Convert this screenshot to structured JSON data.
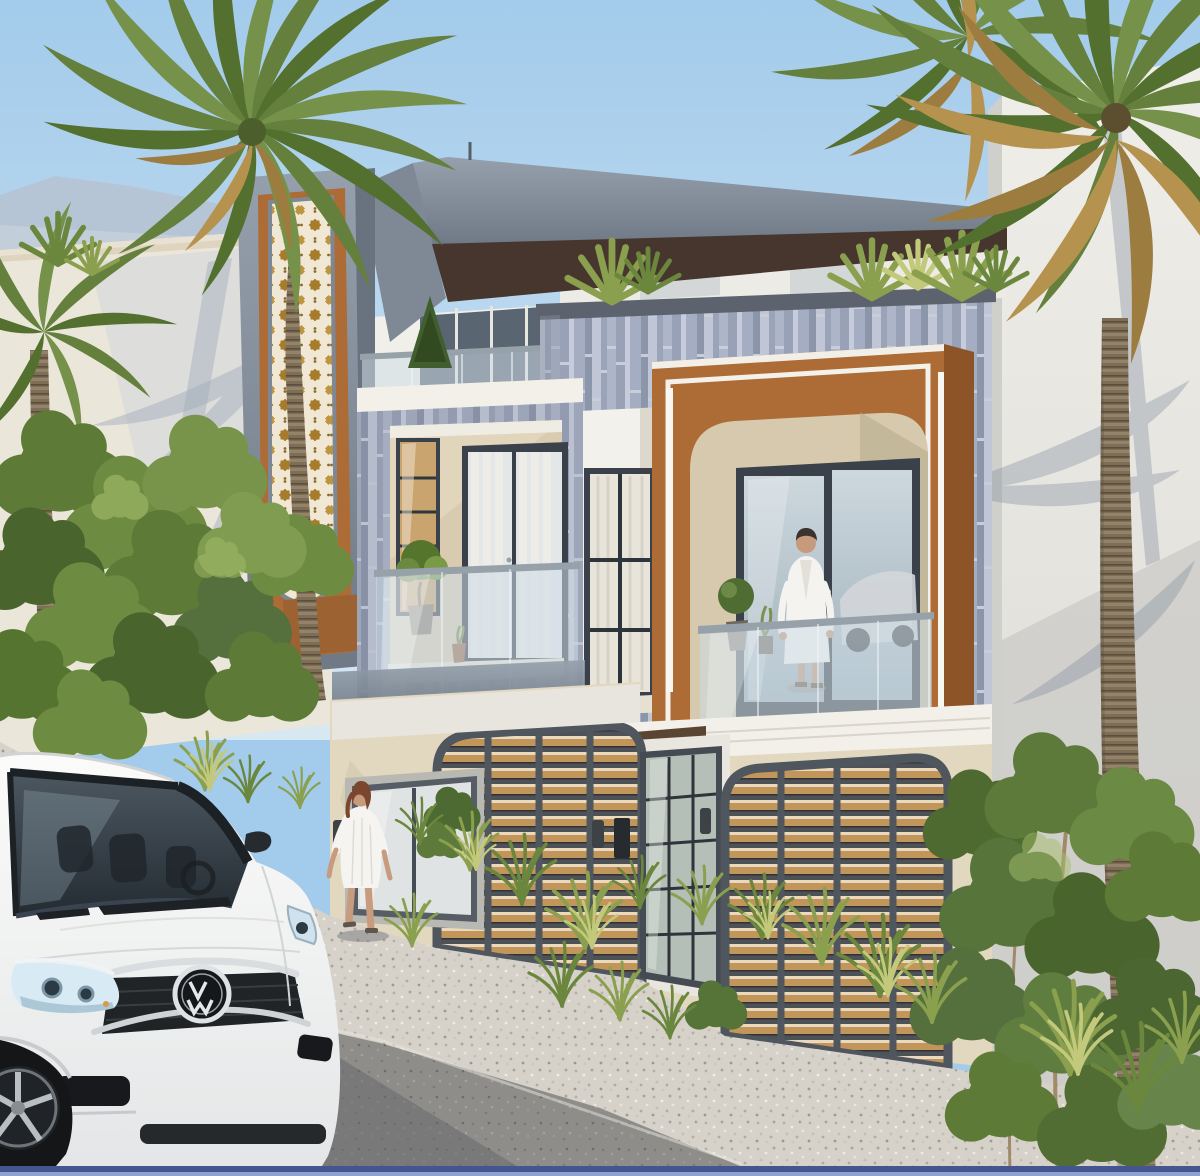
{
  "scene": {
    "description": "Daytime 3D architectural rendering of a modern two-storey duplex villa with rooftop terrace, viewed from its gravel forecourt",
    "sky": "clear light blue, hazy mountains at far left",
    "ground": "light gravel forecourt with darker asphalt drive in the foreground",
    "bottom_edge_strip": "thin blue band at the very bottom of the image"
  },
  "palette": {
    "sky_top": "#a3cbeb",
    "sky_bottom": "#d8e8f3",
    "marble_gray": "#8d98a4",
    "marble_gray_dark": "#6e7985",
    "soffit_brown": "#46362d",
    "stucco_brown": "#ad6b35",
    "stucco_brown_dark": "#8d5527",
    "panel_cream": "#f0e8d5",
    "star_gold": "#a67c2c",
    "tile_blue_gray": "#b3bac9",
    "beige_stone": "#e2d8c0",
    "white_trim": "#f2f0e9",
    "window_frame": "#3a414a",
    "glass": "#cddce6",
    "garage_wood": "#c2955b",
    "gravel_light": "#d6d2ca",
    "asphalt": "#8e8d89",
    "foliage_green": "#5d7a36",
    "palm_green": "#64803c",
    "palm_dry": "#b5934e",
    "van_white": "#f7f7f5",
    "bottom_strip_blue": "#44568f"
  },
  "building": {
    "storeys": 2,
    "left_tower_panel": "vertical rounded-bottom mashrabiya screen, cream lattice with gold eight-point stars in a brown surround framed by gray marble",
    "roof_canopy": "cantilevered gray marble slab with dark brown soffit over a rooftop terrace",
    "roof_terrace": "glass balustrade, white parapet, conifer and spiky rooftop plants",
    "mid_facade": "blue-gray vertical strip tiles with a recessed white-framed curtain window",
    "feature_box": "large tan stucco volume with white trim, arched cut-out balcony and vertical white light strips",
    "first_floor_left": "recessed beige balcony with dark-framed french door, white curtains, glass railing and a potted topiary",
    "ground_floor": "two arched garage doors with horizontal timber louvers and dark steel frames, glazed entry door, picture window, wall sconces and intercom",
    "garage_door_count": 2
  },
  "vehicle": {
    "type": "white minivan parked in the foreground, front three-quarter view",
    "badge_monogram": "VW",
    "details": "chrome double-bar grille, dark mesh, swept headlights, black fog lamp recess, alloy wheel"
  },
  "people": [
    {
      "label": "woman in a white dress walking across the driveway"
    },
    {
      "label": "man in a white bathrobe standing on the arched balcony"
    }
  ],
  "vegetation": {
    "left": "tall date palm and a smaller palm over dense green trees in front of a sunlit neighbour wall with palm shadows",
    "right": "two date palms with dry hanging fronds beside a white neighbour building, leafy shrubs below",
    "ground": "yellow-green grass tufts along the garage fronts and driveway edges",
    "roof": "spiky yucca rosettes above the tiled parapet"
  }
}
